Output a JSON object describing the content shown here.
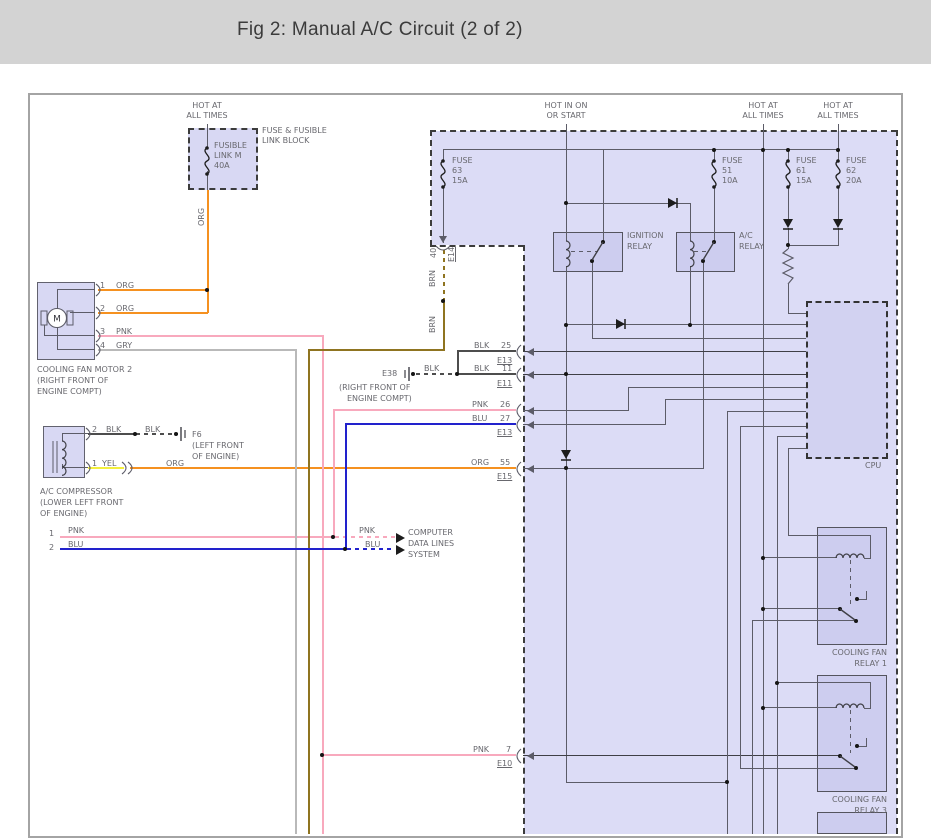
{
  "header": {
    "title": "Fig 2: Manual A/C Circuit (2 of 2)"
  },
  "colors": {
    "org": "#f59120",
    "pnk": "#f8a9bd",
    "blu": "#2222cc",
    "yel": "#f3ef3d",
    "gry": "#b9b9b9",
    "blk": "#4d4d4d",
    "brn": "#8f7420",
    "circuit": "#5c5c68",
    "dark": "#3f3f46",
    "label": "#68686e",
    "box_fill": "#dcdcf6",
    "inner_fill": "#cdcdef",
    "header_bg": "#d3d3d3"
  },
  "labels": [
    {
      "name": "hot-at-all-times-left-1",
      "text": "HOT AT"
    },
    {
      "name": "hot-at-all-times-left-2",
      "text": "ALL TIMES"
    },
    {
      "name": "fusible-link-1",
      "text": "FUSIBLE"
    },
    {
      "name": "fusible-link-2",
      "text": "LINK M"
    },
    {
      "name": "fusible-link-3",
      "text": "40A"
    },
    {
      "name": "fuse-block-1",
      "text": "FUSE & FUSIBLE"
    },
    {
      "name": "fuse-block-2",
      "text": "LINK BLOCK"
    },
    {
      "name": "wire-org-vertical",
      "text": "ORG"
    },
    {
      "name": "motor-pin-1",
      "text": "1"
    },
    {
      "name": "motor-pin-1-color",
      "text": "ORG"
    },
    {
      "name": "motor-pin-2",
      "text": "2"
    },
    {
      "name": "motor-pin-2-color",
      "text": "ORG"
    },
    {
      "name": "motor-pin-3",
      "text": "3"
    },
    {
      "name": "motor-pin-3-color",
      "text": "PNK"
    },
    {
      "name": "motor-pin-4",
      "text": "4"
    },
    {
      "name": "motor-pin-4-color",
      "text": "GRY"
    },
    {
      "name": "motor-name-1",
      "text": "COOLING FAN MOTOR 2"
    },
    {
      "name": "motor-name-2",
      "text": "(RIGHT FRONT OF"
    },
    {
      "name": "motor-name-3",
      "text": "ENGINE COMPT)"
    },
    {
      "name": "compressor-pin-2",
      "text": "2"
    },
    {
      "name": "compressor-pin-2-color",
      "text": "BLK"
    },
    {
      "name": "compressor-pin-2-color-b",
      "text": "BLK"
    },
    {
      "name": "ground-f6",
      "text": "F6"
    },
    {
      "name": "ground-f6-loc-1",
      "text": "(LEFT FRONT"
    },
    {
      "name": "ground-f6-loc-2",
      "text": "OF ENGINE)"
    },
    {
      "name": "compressor-pin-1",
      "text": "1"
    },
    {
      "name": "compressor-pin-1-color",
      "text": "YEL"
    },
    {
      "name": "compressor-pin-1-color-b",
      "text": "ORG"
    },
    {
      "name": "compressor-name-1",
      "text": "A/C COMPRESSOR"
    },
    {
      "name": "compressor-name-2",
      "text": "(LOWER LEFT FRONT"
    },
    {
      "name": "compressor-name-3",
      "text": "OF ENGINE)"
    },
    {
      "name": "dataline-1-num",
      "text": "1"
    },
    {
      "name": "dataline-1-color",
      "text": "PNK"
    },
    {
      "name": "dataline-2-num",
      "text": "2"
    },
    {
      "name": "dataline-2-color",
      "text": "BLU"
    },
    {
      "name": "dataline-1-color-b",
      "text": "PNK"
    },
    {
      "name": "dataline-2-color-b",
      "text": "BLU"
    },
    {
      "name": "computer-datalines-1",
      "text": "COMPUTER"
    },
    {
      "name": "computer-datalines-2",
      "text": "DATA LINES"
    },
    {
      "name": "computer-datalines-3",
      "text": "SYSTEM"
    },
    {
      "name": "ground-e38",
      "text": "E38"
    },
    {
      "name": "ground-e38-color",
      "text": "BLK"
    },
    {
      "name": "ground-e38-loc-1",
      "text": "(RIGHT FRONT OF"
    },
    {
      "name": "ground-e38-loc-2",
      "text": "ENGINE COMPT)"
    },
    {
      "name": "conn-25-color",
      "text": "BLK"
    },
    {
      "name": "conn-25-pin",
      "text": "25"
    },
    {
      "name": "conn-25-name",
      "text": "E13"
    },
    {
      "name": "conn-11-color",
      "text": "BLK"
    },
    {
      "name": "conn-11-pin",
      "text": "11"
    },
    {
      "name": "conn-11-name",
      "text": "E11"
    },
    {
      "name": "conn-26-color",
      "text": "PNK"
    },
    {
      "name": "conn-26-pin",
      "text": "26"
    },
    {
      "name": "conn-27-color",
      "text": "BLU"
    },
    {
      "name": "conn-27-pin",
      "text": "27"
    },
    {
      "name": "conn-27-name",
      "text": "E13"
    },
    {
      "name": "conn-55-color",
      "text": "ORG"
    },
    {
      "name": "conn-55-pin",
      "text": "55"
    },
    {
      "name": "conn-55-name",
      "text": "E15"
    },
    {
      "name": "conn-7-color",
      "text": "PNK"
    },
    {
      "name": "conn-7-pin",
      "text": "7"
    },
    {
      "name": "conn-7-name",
      "text": "E10"
    },
    {
      "name": "hot-in-on-1",
      "text": "HOT IN ON"
    },
    {
      "name": "hot-in-on-2",
      "text": "OR START"
    },
    {
      "name": "hot-at-all-times-mid-1",
      "text": "HOT AT"
    },
    {
      "name": "hot-at-all-times-mid-2",
      "text": "ALL TIMES"
    },
    {
      "name": "hot-at-all-times-right-1",
      "text": "HOT AT"
    },
    {
      "name": "hot-at-all-times-right-2",
      "text": "ALL TIMES"
    },
    {
      "name": "conn-40-pin",
      "text": "40"
    },
    {
      "name": "conn-e14-name",
      "text": "E14"
    },
    {
      "name": "wire-brn-1",
      "text": "BRN"
    },
    {
      "name": "wire-brn-2",
      "text": "BRN"
    },
    {
      "name": "fuse-63-1",
      "text": "FUSE"
    },
    {
      "name": "fuse-63-2",
      "text": "63"
    },
    {
      "name": "fuse-63-3",
      "text": "15A"
    },
    {
      "name": "fuse-51-1",
      "text": "FUSE"
    },
    {
      "name": "fuse-51-2",
      "text": "51"
    },
    {
      "name": "fuse-51-3",
      "text": "10A"
    },
    {
      "name": "fuse-61-1",
      "text": "FUSE"
    },
    {
      "name": "fuse-61-2",
      "text": "61"
    },
    {
      "name": "fuse-61-3",
      "text": "15A"
    },
    {
      "name": "fuse-62-1",
      "text": "FUSE"
    },
    {
      "name": "fuse-62-2",
      "text": "62"
    },
    {
      "name": "fuse-62-3",
      "text": "20A"
    },
    {
      "name": "ignition-relay-1",
      "text": "IGNITION"
    },
    {
      "name": "ignition-relay-2",
      "text": "RELAY"
    },
    {
      "name": "ac-relay-1",
      "text": "A/C"
    },
    {
      "name": "ac-relay-2",
      "text": "RELAY"
    },
    {
      "name": "cpu-label",
      "text": "CPU"
    },
    {
      "name": "cooling-fan-relay1-1",
      "text": "COOLING FAN"
    },
    {
      "name": "cooling-fan-relay1-2",
      "text": "RELAY 1"
    },
    {
      "name": "cooling-fan-relay3-1",
      "text": "COOLING FAN"
    },
    {
      "name": "cooling-fan-relay3-2",
      "text": "RELAY 3"
    }
  ]
}
